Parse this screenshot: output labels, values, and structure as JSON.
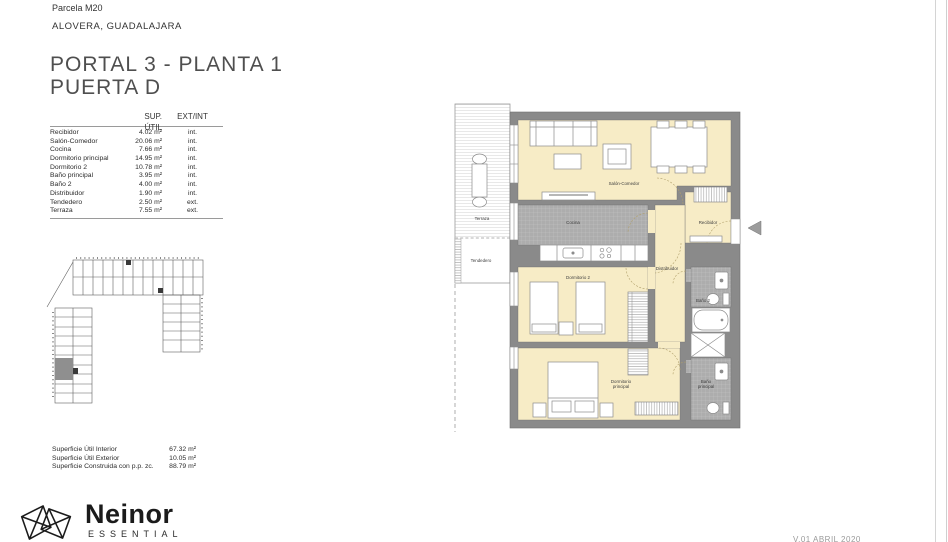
{
  "header": {
    "parcela": "Parcela M20",
    "location": "ALOVERA, GUADALAJARA"
  },
  "title": {
    "line1": "PORTAL 3 - PLANTA 1",
    "line2": "PUERTA D"
  },
  "areas_table": {
    "col_sup": "SUP. ÚTIL",
    "col_ext": "EXT/INT",
    "rows": [
      {
        "name": "Recibidor",
        "area": "4.02 m²",
        "type": "int."
      },
      {
        "name": "Salón-Comedor",
        "area": "20.06 m²",
        "type": "int."
      },
      {
        "name": "Cocina",
        "area": "7.66 m²",
        "type": "int."
      },
      {
        "name": "Dormitorio principal",
        "area": "14.95 m²",
        "type": "int."
      },
      {
        "name": "Dormitorio 2",
        "area": "10.78 m²",
        "type": "int."
      },
      {
        "name": "Baño principal",
        "area": "3.95 m²",
        "type": "int."
      },
      {
        "name": "Baño 2",
        "area": "4.00 m²",
        "type": "int."
      },
      {
        "name": "Distribuidor",
        "area": "1.90 m²",
        "type": "int."
      },
      {
        "name": "Tendedero",
        "area": "2.50 m²",
        "type": "ext."
      },
      {
        "name": "Terraza",
        "area": "7.55 m²",
        "type": "ext."
      }
    ]
  },
  "summary": {
    "rows": [
      {
        "label": "Superficie Útil Interior",
        "value": "67.32 m²"
      },
      {
        "label": "Superficie Útil Exterior",
        "value": "10.05 m²"
      },
      {
        "label": "Superficie Construida con p.p. zc.",
        "value": "88.79 m²"
      }
    ]
  },
  "logo": {
    "brand": "Neinor",
    "sub": "ESSENTIAL"
  },
  "footer_note": "V.01  ABRIL 2020",
  "plan": {
    "labels": {
      "terraza": "Terraza",
      "tendedero": "Tendedero",
      "salon": "Salón-Comedor",
      "cocina": "Cocina",
      "recibidor": "Recibidor",
      "distribuidor": "Distribuidor",
      "dorm2": "Dormitorio 2",
      "dormppal1": "Dormitorio",
      "dormppal2": "principal",
      "bano2": "Baño 2",
      "banoppal1": "Baño",
      "banoppal2": "principal"
    }
  },
  "colors": {
    "room_fill": "#f7ecc6",
    "wall": "#8a8a8a",
    "tile_floor": "#adadad",
    "text": "#2e2e2e"
  }
}
